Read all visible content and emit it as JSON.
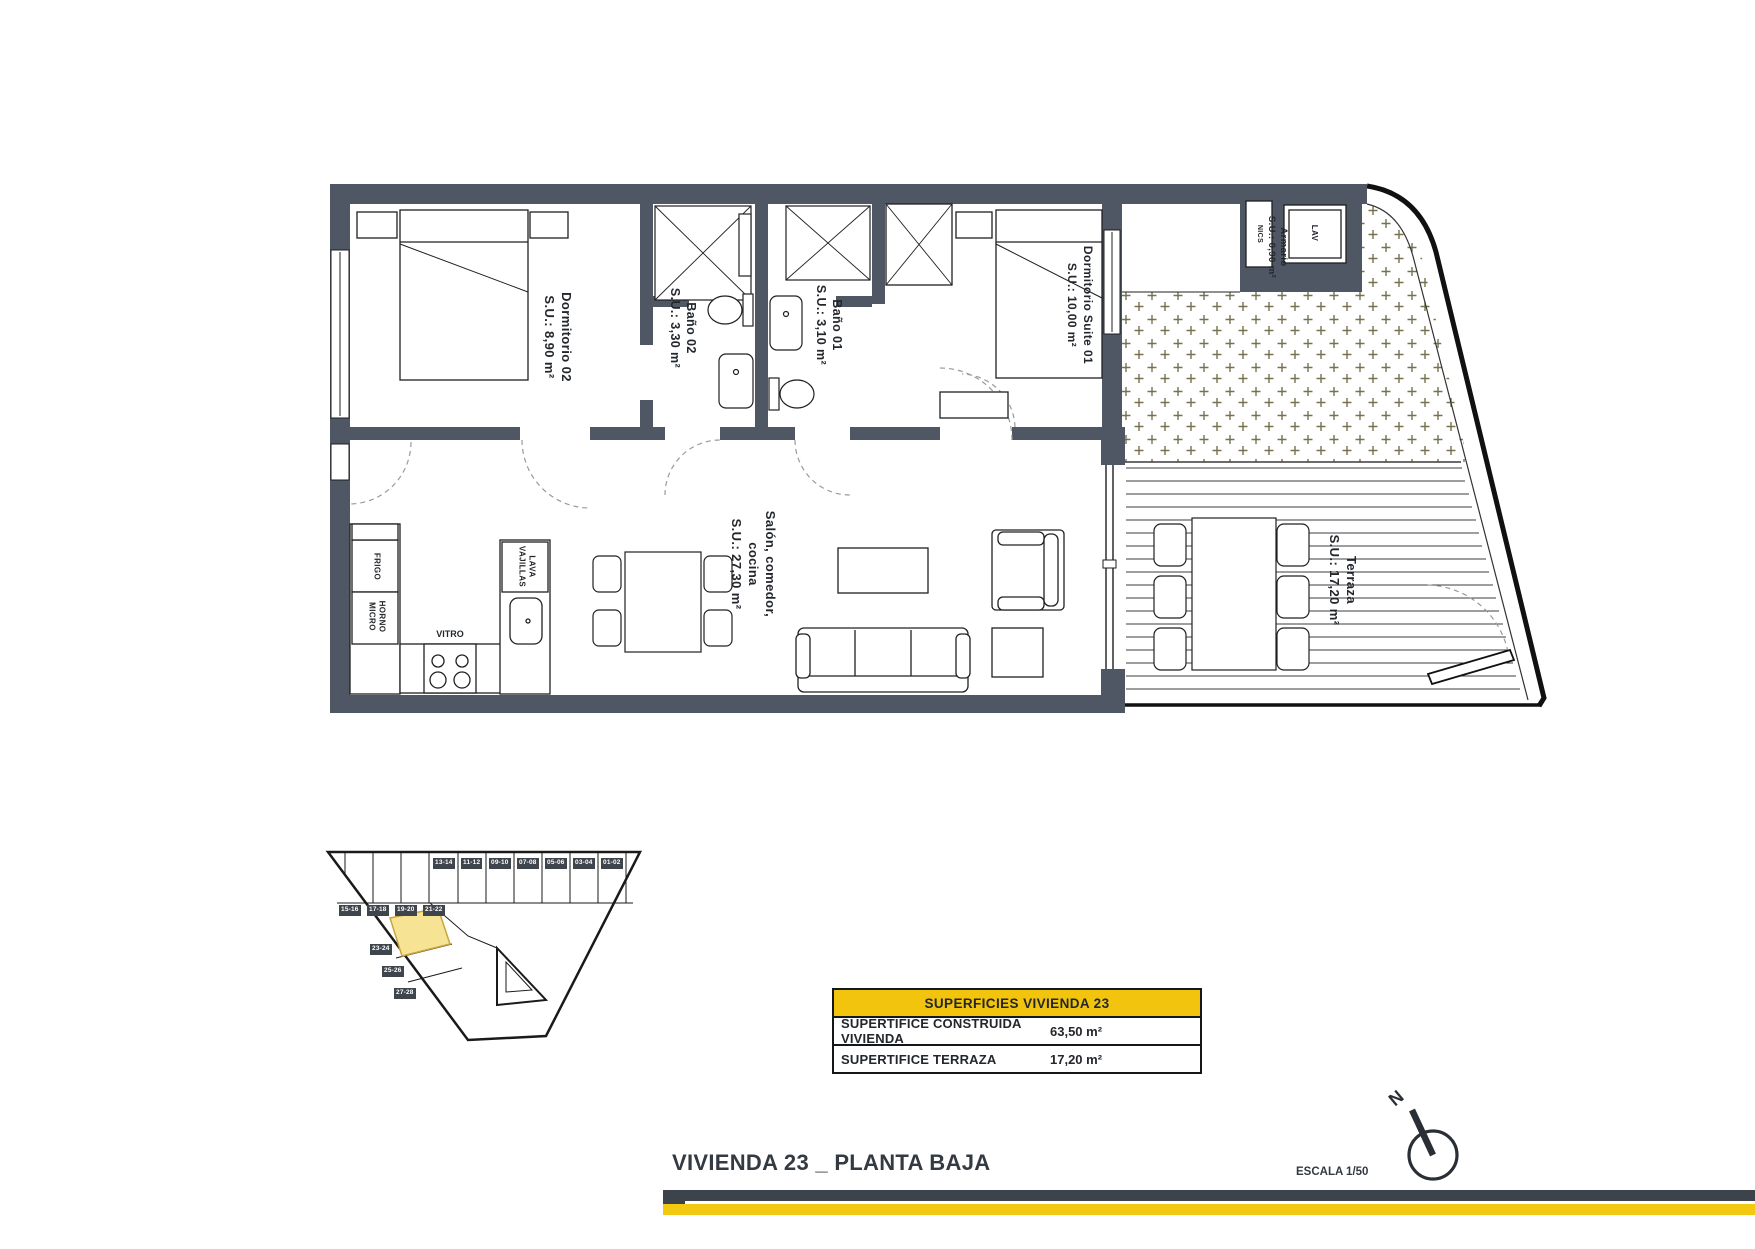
{
  "colors": {
    "wall": "#4e5763",
    "accent_yellow": "#f2c40e",
    "bar_dark": "#3d434b",
    "bar_yellow": "#f2c811",
    "highlight_fill": "#f7e394",
    "highlight_stroke": "#c9a63d"
  },
  "plan": {
    "dormitorio02": {
      "name": "Dormitorio 02",
      "area": "S.U.: 8,90 m²"
    },
    "bano02": {
      "name": "Baño 02",
      "area": "S.U.: 3,30 m²"
    },
    "bano01": {
      "name": "Baño 01",
      "area": "S.U.: 3,10 m²"
    },
    "suite01": {
      "name": "Dormitorio Suite 01",
      "area": "S.U.: 10,00 m²"
    },
    "salon": {
      "name": "Salón, comedor,",
      "name2": "cocina",
      "area": "S.U.: 27,30 m²"
    },
    "terraza": {
      "name": "Terraza",
      "area": "S.U.: 17,20 m²"
    },
    "armario": {
      "name": "Armario",
      "area": "S.U.: 0,90 m²"
    },
    "kitchen": {
      "frigo": "FRIGO",
      "horno1": "HORNO",
      "horno2": "MICRO",
      "vitro": "VITRO",
      "lava1": "LAVA",
      "lava2": "VAJILLAS"
    },
    "laundry": {
      "lav": "LAV",
      "nics": "NICS"
    }
  },
  "site_plan": {
    "top_units": [
      "13-14",
      "11-12",
      "09-10",
      "07-08",
      "05-06",
      "03-04",
      "01-02"
    ],
    "left_units": [
      "15-16",
      "17-18",
      "19-20",
      "21-22"
    ],
    "lower_units": [
      "23-24",
      "25-26",
      "27-28"
    ]
  },
  "summary_table": {
    "header": "SUPERFICIES VIVIENDA 23",
    "rows": [
      {
        "label": "SUPERTIFICE CONSTRUIDA VIVIENDA",
        "value": "63,50 m²"
      },
      {
        "label": "SUPERTIFICE TERRAZA",
        "value": "17,20 m²"
      }
    ]
  },
  "footer": {
    "title": "VIVIENDA 23 _ PLANTA BAJA",
    "scale": "ESCALA 1/50",
    "north": "N"
  }
}
